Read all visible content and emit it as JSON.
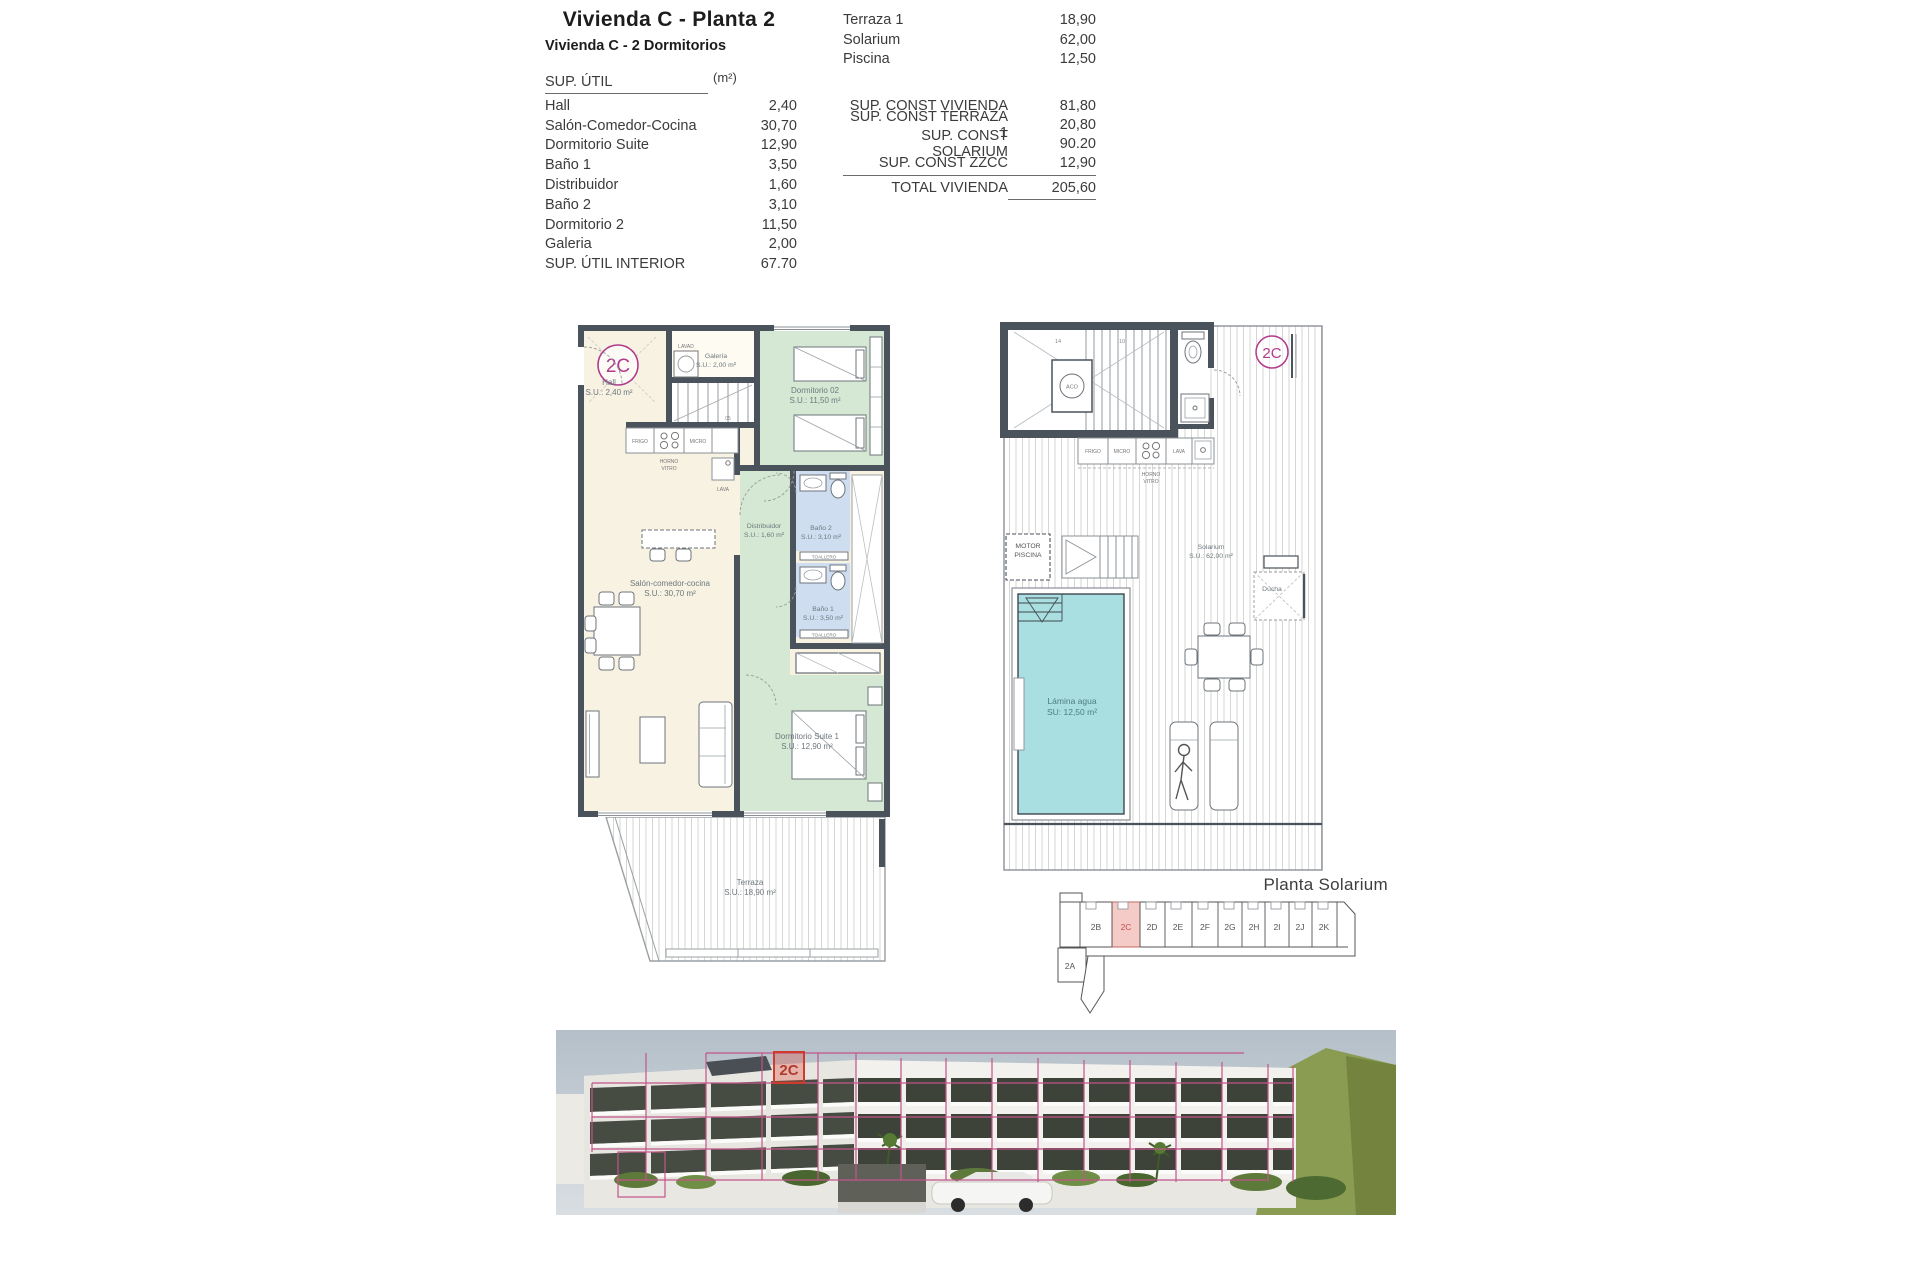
{
  "header": {
    "title": "Vivienda C - Planta 2",
    "subtitle": "Vivienda C - 2 Dormitorios"
  },
  "sup_util": {
    "header_label": "SUP. ÚTIL",
    "header_unit": "(m²)",
    "rows": [
      [
        "Hall",
        "2,40"
      ],
      [
        "Salón-Comedor-Cocina",
        "30,70"
      ],
      [
        "Dormitorio Suite",
        "12,90"
      ],
      [
        "Baño 1",
        "3,50"
      ],
      [
        "Distribuidor",
        "1,60"
      ],
      [
        "Baño 2",
        "3,10"
      ],
      [
        "Dormitorio 2",
        "11,50"
      ],
      [
        "Galeria",
        "2,00"
      ]
    ],
    "total_label": "SUP. ÚTIL INTERIOR",
    "total_value": "67.70"
  },
  "summary": {
    "top_rows": [
      [
        "Terraza 1",
        "18,90"
      ],
      [
        "Solarium",
        "62,00"
      ],
      [
        "Piscina",
        "12,50"
      ]
    ],
    "const_rows": [
      [
        "SUP. CONST VIVIENDA",
        "81,80"
      ],
      [
        "SUP. CONST TERRAZA 1",
        "20,80"
      ],
      [
        "SUP. CONST SOLARIUM",
        "90.20"
      ],
      [
        "SUP. CONST ZZCC",
        "12,90"
      ]
    ],
    "total_label": "TOTAL VIVIENDA",
    "total_value": "205,60"
  },
  "plan2": {
    "badge": "2C",
    "rooms": {
      "hall": {
        "name": "Hall",
        "area": "S.U.: 2,40 m²"
      },
      "galeria": {
        "name": "Galería",
        "area": "S.U.: 2,00 m²"
      },
      "dorm2": {
        "name": "Dormitorio 02",
        "area": "S.U.: 11,50 m²"
      },
      "salon": {
        "name": "Salón-comedor-cocina",
        "area": "S.U.: 30,70 m²"
      },
      "distribuidor": {
        "name": "Distribuidor",
        "area": "S.U.: 1,60 m²"
      },
      "bano2": {
        "name": "Baño 2",
        "area": "S.U.: 3,10 m²"
      },
      "bano1": {
        "name": "Baño 1",
        "area": "S.U.: 3,50 m²"
      },
      "suite": {
        "name": "Dormitorio Suite 1",
        "area": "S.U.: 12,90 m²"
      },
      "terraza": {
        "name": "Terraza",
        "area": "S.U.: 18,90 m²"
      }
    },
    "appliances": {
      "frigo": "FRIGO",
      "micro": "MICRO",
      "horno": "HORNO",
      "vitro": "VITRO",
      "lava": "LAVA",
      "lavad": "LAVAD",
      "toallero": "TOALLERO",
      "stair_num": "05"
    }
  },
  "solarium": {
    "badge": "2C",
    "labels": {
      "motor1": "MOTOR",
      "motor2": "PISCINA",
      "lamina1": "Lámina agua",
      "lamina2": "SU:  12,50 m²",
      "solarium1": "Solarium",
      "solarium2": "S.U.: 62,00 m²",
      "ducha": "Ducha",
      "aco": "ACO",
      "frigo": "FRIGO",
      "micro": "MICRO",
      "lava": "LAVA",
      "horno": "HORNO",
      "vitro": "VITRO",
      "n14": "14",
      "n10": "10"
    }
  },
  "key_plan": {
    "title": "Planta Solarium",
    "units": [
      "2B",
      "2C",
      "2D",
      "2E",
      "2F",
      "2G",
      "2H",
      "2I",
      "2J",
      "2K"
    ],
    "unit_below": "2A",
    "highlighted": "2C"
  },
  "photo": {
    "highlight_label": "2C"
  },
  "colors": {
    "wall": "#4a525b",
    "cream": "#f7f2e2",
    "green": "#d5e8d3",
    "blue": "#cfddf1",
    "pool": "#a9dfe0",
    "magenta": "#b13a8c",
    "pink_fill": "#f5cbc7",
    "pink_line": "#c2558a",
    "red_highlight": "#cc3b2f"
  }
}
